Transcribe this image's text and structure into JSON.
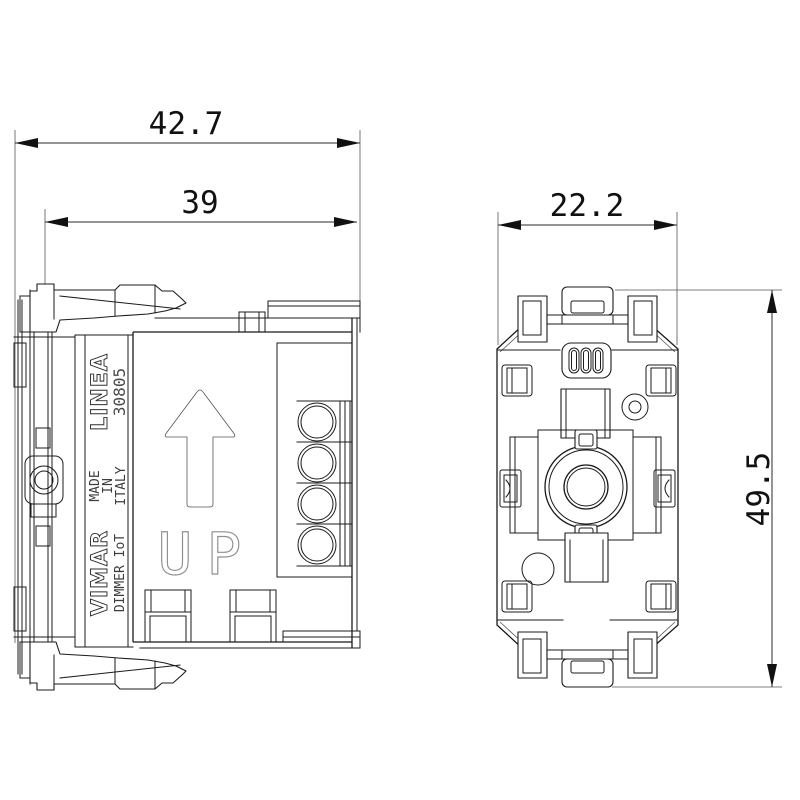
{
  "dimensions": {
    "side_view": {
      "overall_depth": "42.7",
      "body_depth": "39"
    },
    "front_view": {
      "width": "22.2",
      "height": "49.5"
    }
  },
  "markings": {
    "series": "LINEA",
    "article_number": "30805",
    "made_in": [
      "MADE",
      "IN",
      "ITALY"
    ],
    "brand": "VIMAR",
    "model": "DIMMER IoT",
    "up_letters": [
      "U",
      "P"
    ]
  },
  "colors": {
    "line": "#1b1b1b",
    "dimension_text": "#111111",
    "faint_marking": "#8f8f8f",
    "background": "#ffffff"
  }
}
